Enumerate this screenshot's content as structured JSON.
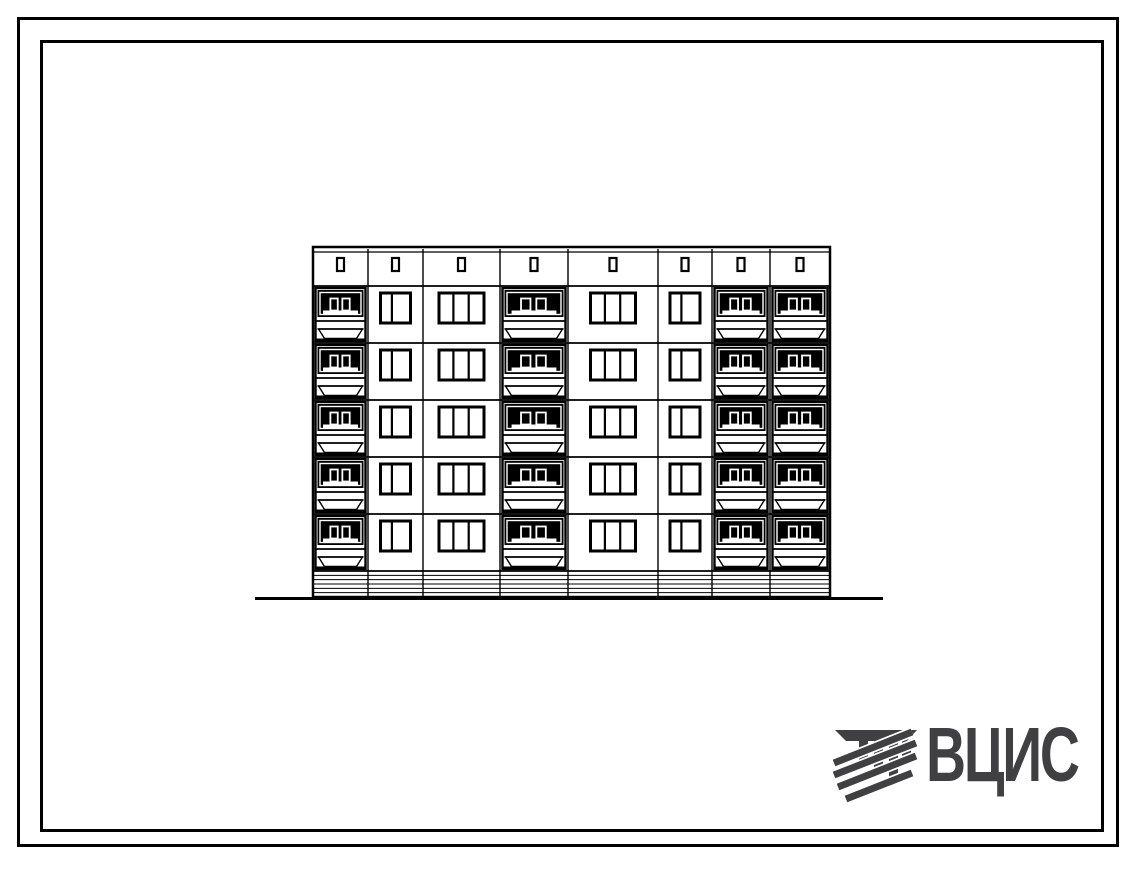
{
  "page": {
    "background": "#ffffff",
    "frame_color": "#000000",
    "ink_color": "#000000"
  },
  "logo": {
    "text": "ВЦИС",
    "color": "#404042",
    "icon": "vcis-column-hatch-emblem"
  },
  "drawing": {
    "kind": "building-elevation",
    "floors": 5,
    "bays": [
      {
        "type": "balcony",
        "width": 55
      },
      {
        "type": "window_small",
        "width": 55
      },
      {
        "type": "window_wide",
        "width": 77
      },
      {
        "type": "balcony",
        "width": 68
      },
      {
        "type": "window_wide",
        "width": 90
      },
      {
        "type": "window_small",
        "width": 54
      },
      {
        "type": "balcony",
        "width": 58
      },
      {
        "type": "balcony",
        "width": 60
      }
    ],
    "geometry": {
      "left": 313,
      "top": 247,
      "coping_line_y": 252,
      "first_floor_line_y": 286,
      "floor_height": 57,
      "plinth_top": 571,
      "plinth_bottom": 597,
      "plinth_stripes": 5,
      "ground_line_y": 598,
      "ground_left": 255,
      "ground_right": 883,
      "vent": {
        "width": 7,
        "height": 13,
        "y": 258
      },
      "window_small": {
        "width": 30,
        "height": 30,
        "top_offset": 7,
        "mullions": [
          0.38
        ]
      },
      "window_wide": {
        "width": 45,
        "height": 30,
        "top_offset": 7,
        "mullions": [
          0.32,
          0.66
        ]
      }
    }
  }
}
